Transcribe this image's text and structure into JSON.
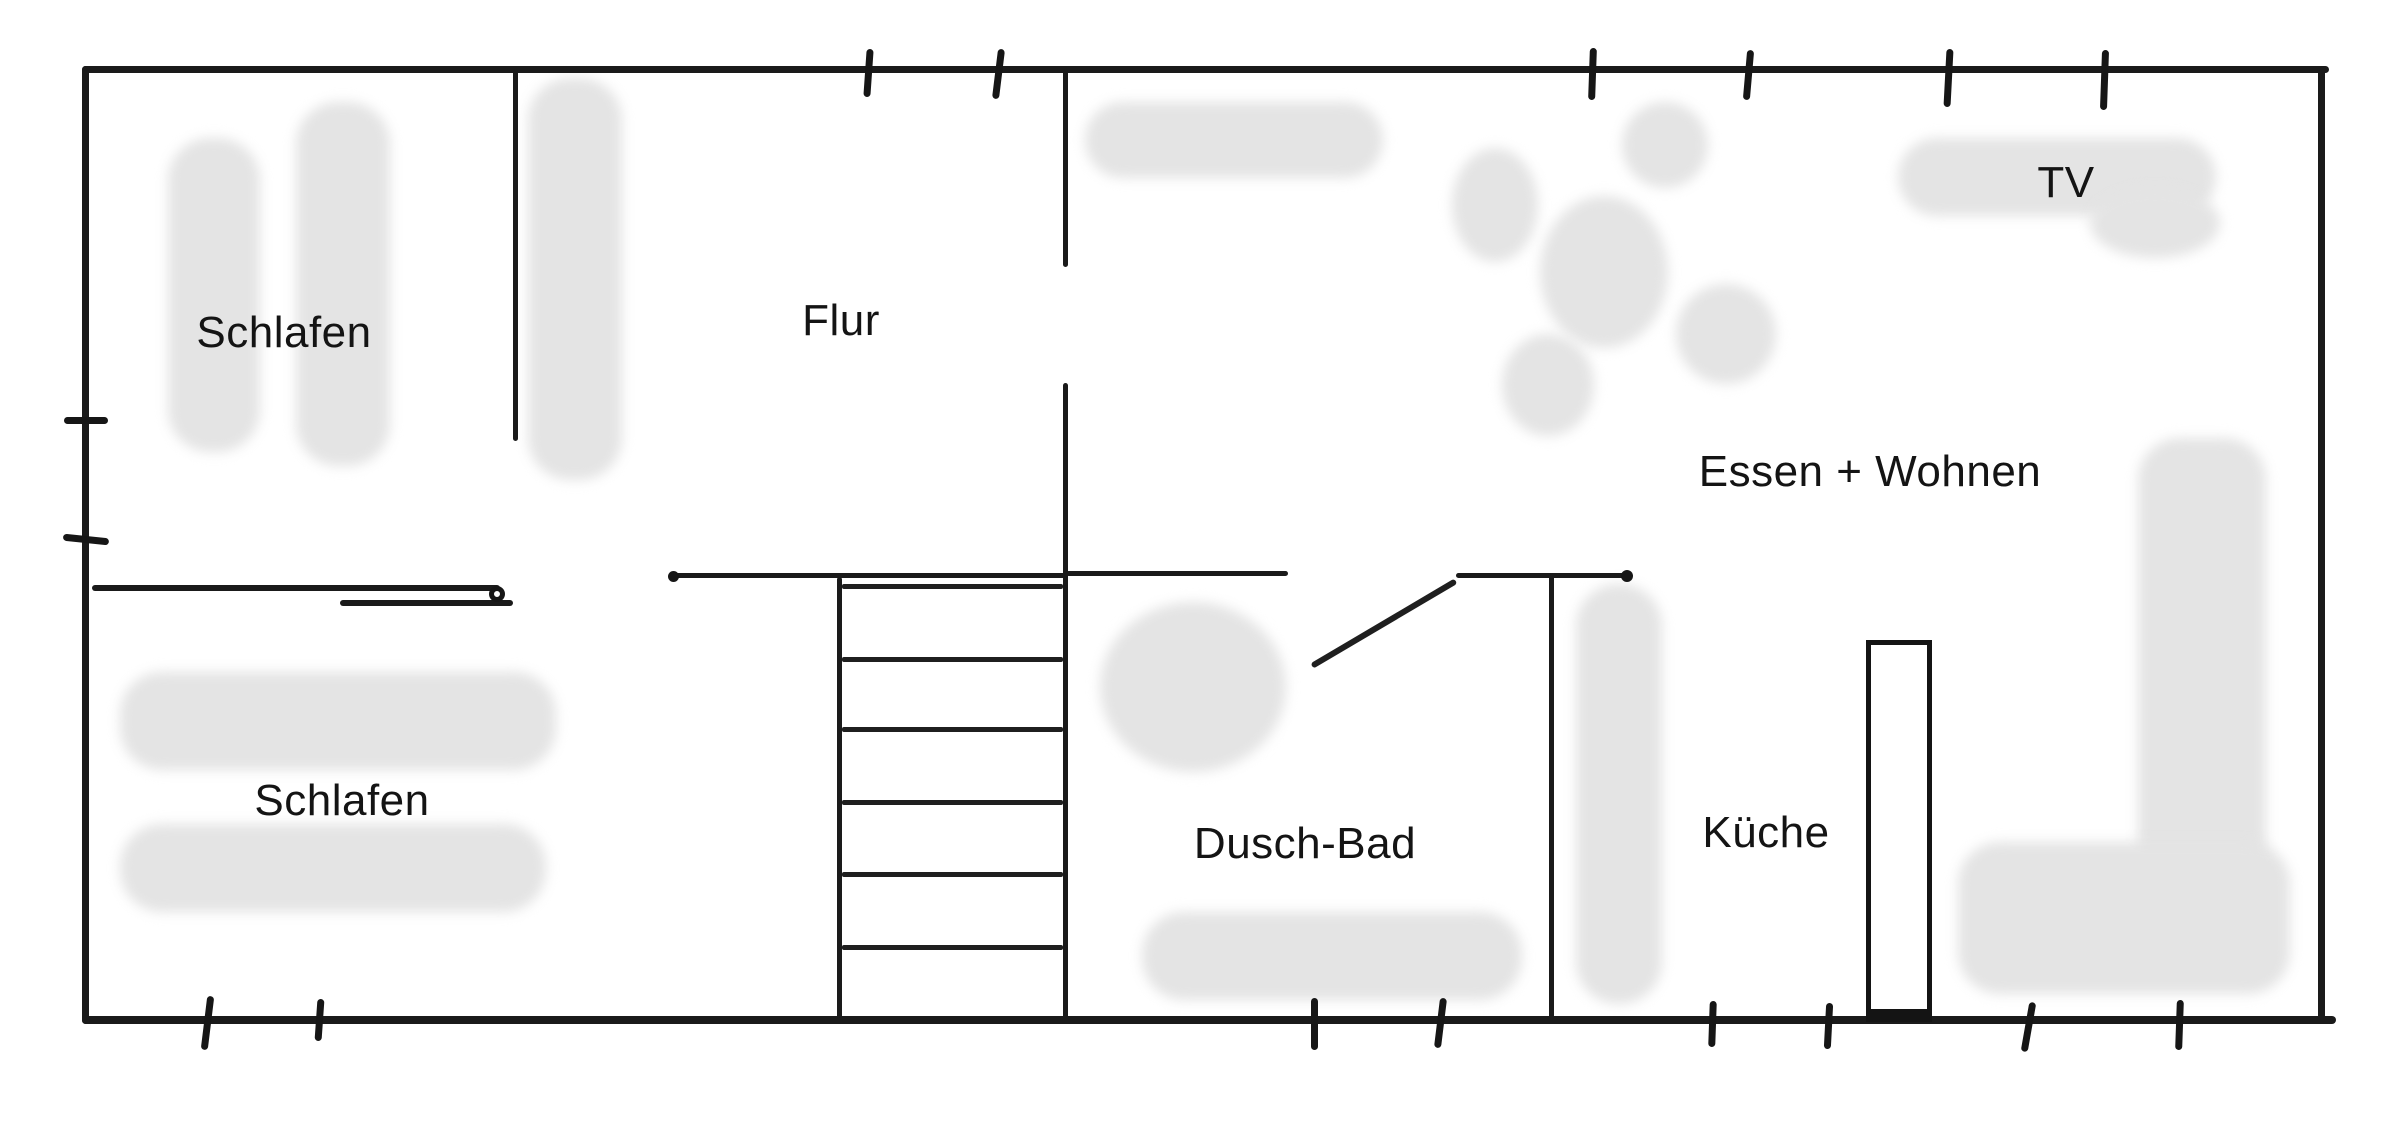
{
  "canvas": {
    "width": 2400,
    "height": 1125
  },
  "colors": {
    "background": "#ffffff",
    "wall": "#1a1a1a",
    "furniture": "#e4e4e4",
    "label": "#141414"
  },
  "rooms": [
    {
      "id": "schlafen-1",
      "label": "Schlafen",
      "x": 284,
      "y": 333
    },
    {
      "id": "flur",
      "label": "Flur",
      "x": 841,
      "y": 321
    },
    {
      "id": "tv",
      "label": "TV",
      "x": 2066,
      "y": 183
    },
    {
      "id": "essen-wohnen",
      "label": "Essen + Wohnen",
      "x": 1870,
      "y": 472
    },
    {
      "id": "schlafen-2",
      "label": "Schlafen",
      "x": 342,
      "y": 801
    },
    {
      "id": "dusch-bad",
      "label": "Dusch-Bad",
      "x": 1305,
      "y": 844
    },
    {
      "id": "kueche",
      "label": "Küche",
      "x": 1766,
      "y": 833
    }
  ],
  "walls": [
    {
      "name": "outer-wall-top",
      "x": 82,
      "y": 66,
      "w": 2247,
      "h": 7
    },
    {
      "name": "outer-wall-bottom",
      "x": 82,
      "y": 1016,
      "w": 2254,
      "h": 8
    },
    {
      "name": "outer-wall-left",
      "x": 82,
      "y": 66,
      "w": 7,
      "h": 958
    },
    {
      "name": "outer-wall-right",
      "x": 2318,
      "y": 66,
      "w": 7,
      "h": 958
    },
    {
      "name": "wall-schlafen-flur",
      "x": 513,
      "y": 69,
      "w": 5,
      "h": 372
    },
    {
      "name": "wall-flur-wohnen-upper",
      "x": 1063,
      "y": 69,
      "w": 5,
      "h": 198
    },
    {
      "name": "wall-flur-wohnen-lower",
      "x": 1063,
      "y": 383,
      "w": 5,
      "h": 638
    },
    {
      "name": "wall-hall-top",
      "x": 671,
      "y": 573,
      "w": 397,
      "h": 5
    },
    {
      "name": "wall-bad-entry-left",
      "x": 1066,
      "y": 571,
      "w": 222,
      "h": 5
    },
    {
      "name": "wall-bad-entry-right",
      "x": 1456,
      "y": 573,
      "w": 172,
      "h": 5
    },
    {
      "name": "wall-bad-right",
      "x": 1549,
      "y": 573,
      "w": 5,
      "h": 448
    },
    {
      "name": "stair-left-rail",
      "x": 837,
      "y": 577,
      "w": 5,
      "h": 444
    }
  ],
  "stairs": {
    "tread_x": 842,
    "tread_w": 221,
    "tread_h": 5,
    "treads": [
      584,
      657,
      727,
      800,
      872,
      945
    ]
  },
  "doors": {
    "sliding_line_long": {
      "x": 92,
      "y": 585,
      "w": 408,
      "h": 6
    },
    "sliding_line_short": {
      "x": 340,
      "y": 600,
      "w": 173,
      "h": 6
    },
    "sliding_ring": {
      "cx": 497,
      "cy": 594,
      "d": 16
    },
    "swing_door": {
      "x1": 1312,
      "y1": 666,
      "x2": 1456,
      "y2": 581,
      "t": 6
    },
    "wall_end_dots": [
      {
        "cx": 673,
        "cy": 576,
        "d": 11
      },
      {
        "cx": 1627,
        "cy": 576,
        "d": 12
      }
    ]
  },
  "kitchen_unit": {
    "x": 1866,
    "y": 640,
    "w": 66,
    "h": 382
  },
  "ticks": [
    {
      "name": "tick-top-1",
      "o": "v",
      "x": 868,
      "y": 73,
      "len": 48,
      "a": 4
    },
    {
      "name": "tick-top-2",
      "o": "v",
      "x": 998,
      "y": 74,
      "len": 50,
      "a": 7
    },
    {
      "name": "tick-top-3",
      "o": "v",
      "x": 1592,
      "y": 74,
      "len": 52,
      "a": 2
    },
    {
      "name": "tick-top-4",
      "o": "v",
      "x": 1748,
      "y": 75,
      "len": 50,
      "a": 5
    },
    {
      "name": "tick-top-5",
      "o": "v",
      "x": 1948,
      "y": 78,
      "len": 58,
      "a": 3
    },
    {
      "name": "tick-top-6",
      "o": "v",
      "x": 2104,
      "y": 80,
      "len": 60,
      "a": 2
    },
    {
      "name": "tick-left-1",
      "o": "h",
      "x": 86,
      "y": 420,
      "len": 44,
      "a": 0
    },
    {
      "name": "tick-left-2",
      "o": "h",
      "x": 86,
      "y": 539,
      "len": 46,
      "a": 6
    },
    {
      "name": "tick-bottom-1",
      "o": "v",
      "x": 207,
      "y": 1023,
      "len": 54,
      "a": 7
    },
    {
      "name": "tick-bottom-2",
      "o": "v",
      "x": 319,
      "y": 1020,
      "len": 42,
      "a": 4
    },
    {
      "name": "tick-bottom-3",
      "o": "v",
      "x": 1314,
      "y": 1024,
      "len": 52,
      "a": 0
    },
    {
      "name": "tick-bottom-4",
      "o": "v",
      "x": 1440,
      "y": 1023,
      "len": 50,
      "a": 7
    },
    {
      "name": "tick-bottom-5",
      "o": "v",
      "x": 1712,
      "y": 1024,
      "len": 46,
      "a": 2
    },
    {
      "name": "tick-bottom-6",
      "o": "v",
      "x": 1828,
      "y": 1026,
      "len": 46,
      "a": 3
    },
    {
      "name": "tick-bottom-7",
      "o": "v",
      "x": 2028,
      "y": 1027,
      "len": 50,
      "a": 10
    },
    {
      "name": "tick-bottom-8",
      "o": "v",
      "x": 2179,
      "y": 1025,
      "len": 50,
      "a": 2
    }
  ],
  "furniture": [
    {
      "name": "bed-strip-1",
      "x": 168,
      "y": 138,
      "w": 92,
      "h": 314,
      "round": false
    },
    {
      "name": "bed-strip-2",
      "x": 296,
      "y": 102,
      "w": 94,
      "h": 364,
      "round": false
    },
    {
      "name": "wardrobe-strip",
      "x": 528,
      "y": 78,
      "w": 94,
      "h": 402,
      "round": false
    },
    {
      "name": "sideboard",
      "x": 1085,
      "y": 102,
      "w": 298,
      "h": 76,
      "round": false
    },
    {
      "name": "dining-chair-top",
      "x": 1622,
      "y": 102,
      "w": 86,
      "h": 86,
      "round": true
    },
    {
      "name": "dining-chair-left",
      "x": 1452,
      "y": 148,
      "w": 86,
      "h": 114,
      "round": true
    },
    {
      "name": "dining-table",
      "x": 1540,
      "y": 196,
      "w": 128,
      "h": 152,
      "round": true
    },
    {
      "name": "dining-chair-right",
      "x": 1676,
      "y": 284,
      "w": 100,
      "h": 100,
      "round": true
    },
    {
      "name": "dining-chair-bottom",
      "x": 1502,
      "y": 334,
      "w": 92,
      "h": 102,
      "round": true
    },
    {
      "name": "tv-board",
      "x": 1898,
      "y": 138,
      "w": 318,
      "h": 78,
      "round": false
    },
    {
      "name": "tv-board-end",
      "x": 2090,
      "y": 188,
      "w": 130,
      "h": 70,
      "round": true
    },
    {
      "name": "sofa-back",
      "x": 2138,
      "y": 438,
      "w": 128,
      "h": 468,
      "round": false
    },
    {
      "name": "sofa-seat",
      "x": 1958,
      "y": 842,
      "w": 332,
      "h": 152,
      "round": false
    },
    {
      "name": "shower",
      "x": 1100,
      "y": 602,
      "w": 186,
      "h": 170,
      "round": true
    },
    {
      "name": "bath-strip",
      "x": 1142,
      "y": 912,
      "w": 380,
      "h": 88,
      "round": false
    },
    {
      "name": "kitchen-strip",
      "x": 1576,
      "y": 584,
      "w": 86,
      "h": 420,
      "round": false
    },
    {
      "name": "bed-strip-3",
      "x": 120,
      "y": 672,
      "w": 436,
      "h": 98,
      "round": false
    },
    {
      "name": "bed-strip-4",
      "x": 120,
      "y": 824,
      "w": 426,
      "h": 88,
      "round": false
    }
  ]
}
